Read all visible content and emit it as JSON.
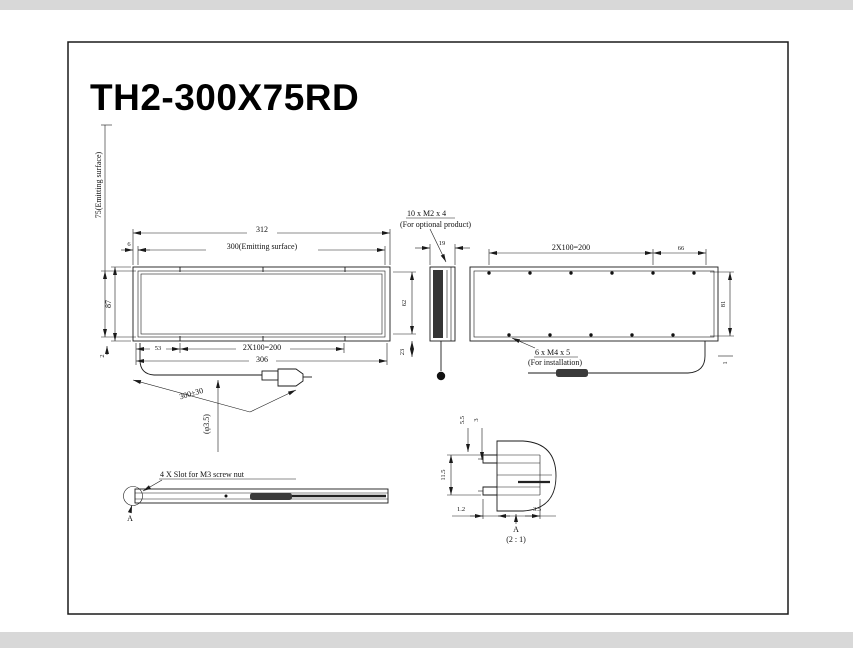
{
  "title": "TH2-300X75RD",
  "colors": {
    "paper": "#ffffff",
    "band": "#d8d8d8",
    "line": "#1a1a1a"
  },
  "front_view": {
    "dim_width_overall": "312",
    "dim_width_emitting": "300(Emitting surface)",
    "dim_edge_offset": "6",
    "dim_height_overall": "87",
    "dim_height_emitting": "75(Emitting surface)",
    "dim_bottom_left": "53",
    "dim_bottom_spacing": "2X100=200",
    "dim_bottom_span": "306",
    "dim_corner": "2",
    "cable_length": "300±30",
    "cable_diameter": "(φ3.5)"
  },
  "side_view": {
    "dim_depth": "19",
    "dim_inner": "62",
    "dim_lower": "23"
  },
  "rear_view": {
    "dim_hole_spacing": "2X100=200",
    "dim_right_offset": "66",
    "dim_height": "81",
    "dim_bottom_offset": "1",
    "callout_optional_line1": "10 x M2 x 4",
    "callout_optional_line2": "(For optional product)",
    "callout_install_line1": "6 x M4 x 5",
    "callout_install_line2": "(For installation)"
  },
  "slot_view": {
    "label": "4 X Slot for M3 screw nut",
    "detail_marker": "A"
  },
  "detail_view": {
    "dim_top_1": "5.5",
    "dim_top_2": "3",
    "dim_side": "11.5",
    "dim_bottom_1": "1.2",
    "dim_bottom_2": "3.5",
    "label": "A",
    "scale": "(2 : 1)"
  }
}
